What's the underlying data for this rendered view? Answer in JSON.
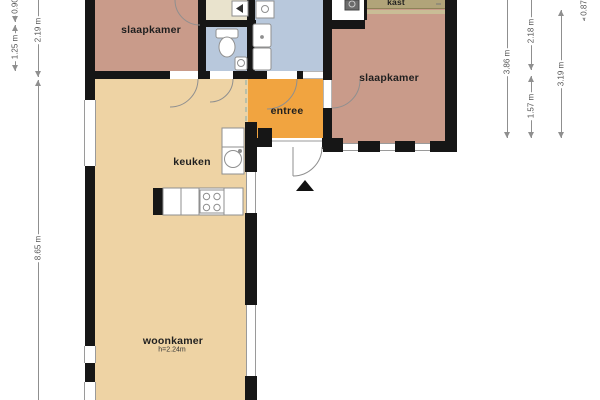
{
  "colors": {
    "wall": "#161616",
    "bedroom_salmon": "#c99b8a",
    "living_tan": "#eed3a4",
    "entry_orange": "#f1a440",
    "bath_blue": "#b8c8dc",
    "hall_beige": "#e9e3cd",
    "closet_khaki": "#b1a479",
    "closet_light": "#c9bd96",
    "dimension_line": "#8f8f8f"
  },
  "rooms": {
    "bedroom_left": {
      "label": "slaapkamer"
    },
    "bedroom_right": {
      "label": "slaapkamer"
    },
    "entry": {
      "label": "entree"
    },
    "kitchen": {
      "label": "keuken"
    },
    "living_room": {
      "label": "woonkamer",
      "ceiling_note": "h=2.24m"
    },
    "closet": {
      "label": "kast"
    }
  },
  "dimensions": {
    "left": [
      {
        "label": "0.90"
      },
      {
        "label": "1.25 m"
      },
      {
        "label": "2.19 m"
      },
      {
        "label": "8.65 m"
      }
    ],
    "right": [
      {
        "label": "3.86 m"
      },
      {
        "label": "2.18 m"
      },
      {
        "label": "1.57 m"
      },
      {
        "label": "3.19 m"
      },
      {
        "label": "0.87"
      }
    ]
  },
  "fixtures": [
    "toilet",
    "hand-basin",
    "shower",
    "washbasin",
    "washing-machine",
    "boiler-cupboard",
    "kitchen-sink",
    "stove",
    "kitchen-counter",
    "entrance-arrow",
    "front-door"
  ]
}
